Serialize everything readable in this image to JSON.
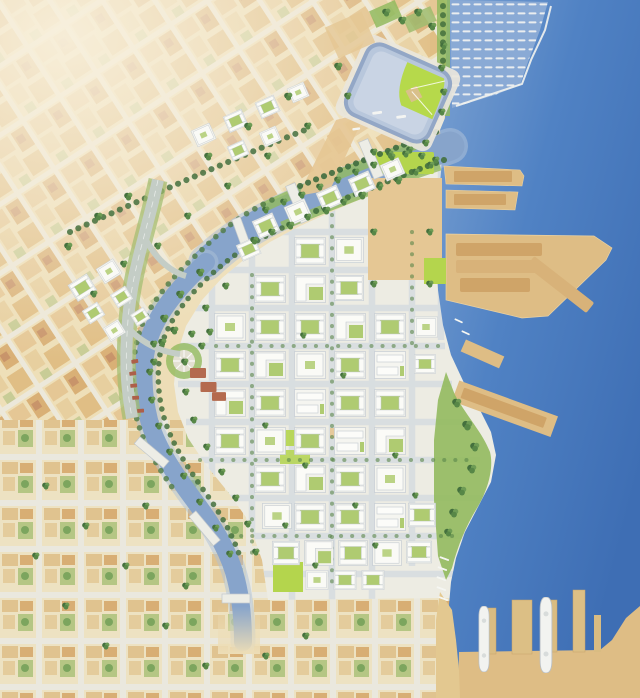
{
  "image": {
    "kind": "watercolor-masterplan-map",
    "description": "Aerial watercolor rendering of a waterfront urban redevelopment masterplan: a ballpark and small-craft marina at top, a bay with cargo piers on the right, a canal/creek curving through the plan, new white mixed-use blocks with green courtyards in the center, an existing diagonal city grid at upper left and an orthogonal residential grid at bottom left.",
    "width": 640,
    "height": 698
  },
  "palette": {
    "water_deep": "#3E6EB4",
    "water_mid": "#5082C4",
    "water_light": "#7CA2D2",
    "marina_water": "#8AAAD5",
    "channel": "#87A4CB",
    "channel_light": "#AEC1D8",
    "land_base": "#EDDDB6",
    "land_faded": "#F6EDD7",
    "dev_base": "#EDECE3",
    "street_new": "#D8DDDF",
    "block_white": "#FAFAF6",
    "block_edge": "#C5CCD3",
    "courtyard": "#AFCB71",
    "park": "#92BA5E",
    "field": "#B4D54D",
    "tree_dark": "#44703E",
    "tree_mid": "#6E9C55",
    "sand": "#E5C794",
    "pier": "#DEBD85",
    "pier_light": "#EAD2A4",
    "warehouse": "#CFA468",
    "beach": "#E3C890",
    "stadium_plaza": "#E9E6DC",
    "stadium_bowl": "#B8C7DC",
    "stadium_seats": "#C9D4E4",
    "stadium_rim": "#93A7C6",
    "stadium_field": "#B6D94B",
    "infield": "#D9C08A",
    "freeway": "#C4CDC6",
    "ramp_green": "#9FBC6F",
    "brick": "#B46A4E",
    "ship": "#F2F3F0",
    "dock_white": "#F5F6F2",
    "old_block_a": "#E5C795",
    "old_block_b": "#D9B076",
    "old_accent": "#C8946A",
    "street_old": "#ECE8DA"
  },
  "features": {
    "ballpark": "baseball stadium with green field at top center",
    "marina": "small-craft marina with rows of boat slips, top right",
    "breakwater": "curved breakwater line around marina",
    "channel": "canal inlet running southwest from the bay",
    "creek": "creek curving south past houseboats, fading at bottom",
    "cargo_piers": "large tan finger piers with warehouses on the bay",
    "south_piers": "vertical piers with two white ships, bottom right",
    "plaza": "large tan open parcel in the new district",
    "round_plaza": "circular plaza with radiating paths",
    "waterfront_park": "green shoreline park on the eastern bulge",
    "freeway": "elevated freeway stub with landscaped ramps",
    "old_grid": "existing diagonal city grid, upper left",
    "south_grid": "existing orthogonal residential grid, bottom",
    "new_blocks": "new white development blocks with green courtyards"
  },
  "map_items": {
    "dev_blocks": [
      [
        294,
        236,
        32,
        30,
        "b1"
      ],
      [
        334,
        236,
        30,
        28,
        "b4"
      ],
      [
        254,
        274,
        32,
        30,
        "b1"
      ],
      [
        294,
        274,
        32,
        30,
        "b3"
      ],
      [
        334,
        274,
        30,
        28,
        "b1"
      ],
      [
        214,
        312,
        32,
        30,
        "b4"
      ],
      [
        254,
        312,
        32,
        30,
        "b1"
      ],
      [
        294,
        312,
        32,
        30,
        "b1"
      ],
      [
        334,
        312,
        32,
        30,
        "b3"
      ],
      [
        374,
        312,
        32,
        30,
        "b1"
      ],
      [
        414,
        312,
        24,
        30,
        "b4"
      ],
      [
        214,
        350,
        32,
        30,
        "b1"
      ],
      [
        254,
        350,
        32,
        30,
        "b3"
      ],
      [
        294,
        350,
        32,
        30,
        "b4"
      ],
      [
        334,
        350,
        32,
        30,
        "b1"
      ],
      [
        374,
        350,
        32,
        30,
        "b2"
      ],
      [
        414,
        350,
        22,
        28,
        "b1"
      ],
      [
        214,
        388,
        32,
        30,
        "b3"
      ],
      [
        254,
        388,
        32,
        30,
        "b1"
      ],
      [
        294,
        388,
        32,
        30,
        "b2"
      ],
      [
        334,
        388,
        32,
        30,
        "b1"
      ],
      [
        374,
        388,
        32,
        30,
        "b1"
      ],
      [
        214,
        426,
        32,
        30,
        "b1"
      ],
      [
        254,
        426,
        32,
        30,
        "b4"
      ],
      [
        294,
        426,
        32,
        30,
        "b1"
      ],
      [
        334,
        426,
        32,
        30,
        "b2"
      ],
      [
        374,
        426,
        32,
        30,
        "b3"
      ],
      [
        254,
        464,
        32,
        30,
        "b1"
      ],
      [
        294,
        464,
        32,
        30,
        "b3"
      ],
      [
        334,
        464,
        32,
        30,
        "b1"
      ],
      [
        374,
        464,
        32,
        30,
        "b4"
      ],
      [
        262,
        502,
        30,
        28,
        "b4"
      ],
      [
        294,
        502,
        32,
        30,
        "b1"
      ],
      [
        334,
        502,
        32,
        30,
        "b1"
      ],
      [
        374,
        502,
        32,
        30,
        "b2"
      ],
      [
        408,
        502,
        28,
        26,
        "b1"
      ],
      [
        272,
        540,
        28,
        26,
        "b1"
      ],
      [
        304,
        540,
        30,
        26,
        "b3"
      ],
      [
        338,
        540,
        30,
        26,
        "b1"
      ],
      [
        372,
        540,
        30,
        26,
        "b4"
      ],
      [
        406,
        540,
        26,
        24,
        "b1"
      ],
      [
        304,
        570,
        26,
        20,
        "b4"
      ],
      [
        332,
        570,
        26,
        20,
        "b1"
      ],
      [
        360,
        570,
        26,
        20,
        "b1"
      ]
    ],
    "channel_blocks": [
      [
        250,
        222,
        26,
        20,
        "b1",
        -24
      ],
      [
        282,
        208,
        26,
        20,
        "b4",
        -24
      ],
      [
        314,
        194,
        26,
        20,
        "b1",
        -24
      ],
      [
        346,
        180,
        26,
        20,
        "b1",
        -24
      ],
      [
        378,
        166,
        24,
        18,
        "b4",
        -24
      ],
      [
        234,
        246,
        24,
        18,
        "b1",
        -24
      ]
    ],
    "north_blocks": [
      [
        188,
        132,
        26,
        18,
        "b4",
        -24
      ],
      [
        220,
        118,
        26,
        18,
        "b1",
        -24
      ],
      [
        252,
        104,
        26,
        18,
        "b1",
        -24
      ],
      [
        284,
        90,
        24,
        16,
        "b4",
        -24
      ],
      [
        224,
        148,
        24,
        16,
        "b1",
        -24
      ],
      [
        256,
        134,
        24,
        16,
        "b4",
        -24
      ]
    ],
    "west_blocks": [
      [
        66,
        286,
        26,
        20,
        "b1",
        -32
      ],
      [
        94,
        270,
        24,
        18,
        "b4",
        -32
      ],
      [
        80,
        312,
        22,
        16,
        "b1",
        -32
      ],
      [
        108,
        296,
        22,
        16,
        "b1",
        -32
      ],
      [
        100,
        330,
        24,
        16,
        "b4",
        -32
      ],
      [
        128,
        316,
        20,
        14,
        "b1",
        -32
      ]
    ],
    "brick_buildings": [
      [
        190,
        368,
        16,
        10,
        "bk"
      ],
      [
        200,
        382,
        17,
        10,
        "bk"
      ],
      [
        212,
        392,
        14,
        9,
        "bk"
      ]
    ],
    "houseboats": [
      [
        131,
        360,
        7,
        4,
        "hb",
        -10
      ],
      [
        129,
        372,
        7,
        4,
        "hb",
        -8
      ],
      [
        130,
        384,
        7,
        4,
        "hb",
        -6
      ],
      [
        132,
        396,
        7,
        4,
        "hb",
        -4
      ],
      [
        137,
        409,
        7,
        4,
        "hb",
        -4
      ]
    ],
    "ships": [
      [
        478,
        606,
        12,
        66,
        "ship"
      ],
      [
        539,
        597,
        14,
        76,
        "ship"
      ]
    ],
    "boats": [
      [
        372,
        112,
        10,
        3,
        "boat",
        -8
      ],
      [
        396,
        116,
        10,
        3,
        "boat",
        -8
      ],
      [
        352,
        128,
        8,
        3,
        "boat",
        -8
      ]
    ],
    "docks": [
      [
        440,
        556,
        10,
        2,
        "dock",
        20
      ],
      [
        438,
        566,
        10,
        2,
        "dock",
        20
      ],
      [
        437,
        576,
        10,
        2,
        "dock",
        20
      ],
      [
        437,
        586,
        10,
        2,
        "dock",
        20
      ],
      [
        439,
        596,
        10,
        2,
        "dock",
        20
      ],
      [
        455,
        318,
        9,
        2,
        "dock",
        25
      ],
      [
        462,
        330,
        9,
        2,
        "dock",
        25
      ]
    ],
    "trees": [
      [
        250,
        236,
        9
      ],
      [
        268,
        228,
        8
      ],
      [
        286,
        221,
        9
      ],
      [
        304,
        213,
        8
      ],
      [
        322,
        206,
        9
      ],
      [
        340,
        198,
        8
      ],
      [
        358,
        191,
        9
      ],
      [
        376,
        183,
        8
      ],
      [
        394,
        176,
        9
      ],
      [
        412,
        168,
        8
      ],
      [
        427,
        161,
        8
      ],
      [
        262,
        206,
        8
      ],
      [
        280,
        198,
        8
      ],
      [
        298,
        191,
        8
      ],
      [
        316,
        183,
        8
      ],
      [
        334,
        176,
        8
      ],
      [
        352,
        168,
        8
      ],
      [
        370,
        161,
        8
      ],
      [
        388,
        153,
        8
      ],
      [
        406,
        146,
        8
      ],
      [
        422,
        139,
        8
      ],
      [
        196,
        268,
        9
      ],
      [
        176,
        290,
        9
      ],
      [
        160,
        314,
        9
      ],
      [
        150,
        340,
        8
      ],
      [
        146,
        368,
        8
      ],
      [
        148,
        396,
        8
      ],
      [
        155,
        422,
        8
      ],
      [
        166,
        448,
        8
      ],
      [
        180,
        472,
        8
      ],
      [
        196,
        498,
        8
      ],
      [
        212,
        524,
        8
      ],
      [
        226,
        550,
        8
      ],
      [
        222,
        282,
        8
      ],
      [
        202,
        304,
        8
      ],
      [
        188,
        330,
        8
      ],
      [
        181,
        358,
        8
      ],
      [
        182,
        388,
        8
      ],
      [
        190,
        416,
        8
      ],
      [
        203,
        443,
        8
      ],
      [
        218,
        468,
        8
      ],
      [
        232,
        494,
        8
      ],
      [
        244,
        520,
        8
      ],
      [
        252,
        548,
        8
      ],
      [
        452,
        398,
        10
      ],
      [
        462,
        420,
        11
      ],
      [
        470,
        442,
        10
      ],
      [
        467,
        464,
        10
      ],
      [
        457,
        486,
        10
      ],
      [
        449,
        508,
        10
      ],
      [
        444,
        528,
        9
      ],
      [
        382,
        8,
        9
      ],
      [
        398,
        16,
        9
      ],
      [
        414,
        8,
        9
      ],
      [
        428,
        22,
        9
      ],
      [
        440,
        42,
        8
      ],
      [
        438,
        64,
        8
      ],
      [
        440,
        88,
        8
      ],
      [
        438,
        108,
        8
      ],
      [
        370,
        148,
        8
      ],
      [
        386,
        150,
        8
      ],
      [
        402,
        150,
        8
      ],
      [
        418,
        152,
        8
      ],
      [
        432,
        156,
        8
      ],
      [
        370,
        228,
        8
      ],
      [
        426,
        228,
        8
      ],
      [
        370,
        280,
        8
      ],
      [
        426,
        280,
        8
      ],
      [
        158,
        338,
        9
      ],
      [
        170,
        326,
        9
      ],
      [
        150,
        358,
        8
      ],
      [
        198,
        342,
        8
      ],
      [
        206,
        328,
        8
      ],
      [
        300,
        332,
        7
      ],
      [
        340,
        372,
        7
      ],
      [
        262,
        422,
        7
      ],
      [
        302,
        462,
        7
      ],
      [
        352,
        502,
        7
      ],
      [
        282,
        522,
        7
      ],
      [
        392,
        452,
        7
      ],
      [
        412,
        492,
        7
      ],
      [
        372,
        542,
        7
      ],
      [
        312,
        562,
        7
      ],
      [
        64,
        242,
        9
      ],
      [
        94,
        212,
        9
      ],
      [
        124,
        192,
        9
      ],
      [
        204,
        152,
        9
      ],
      [
        244,
        122,
        9
      ],
      [
        284,
        92,
        9
      ],
      [
        334,
        62,
        9
      ],
      [
        154,
        242,
        8
      ],
      [
        184,
        212,
        8
      ],
      [
        224,
        182,
        8
      ],
      [
        264,
        152,
        8
      ],
      [
        304,
        122,
        8
      ],
      [
        344,
        92,
        8
      ],
      [
        120,
        260,
        8
      ],
      [
        90,
        290,
        8
      ],
      [
        42,
        482,
        8
      ],
      [
        82,
        522,
        8
      ],
      [
        122,
        562,
        8
      ],
      [
        62,
        602,
        8
      ],
      [
        102,
        642,
        8
      ],
      [
        162,
        622,
        8
      ],
      [
        202,
        662,
        8
      ],
      [
        32,
        552,
        8
      ],
      [
        142,
        502,
        8
      ],
      [
        182,
        582,
        8
      ],
      [
        262,
        652,
        8
      ],
      [
        302,
        632,
        8
      ]
    ]
  }
}
